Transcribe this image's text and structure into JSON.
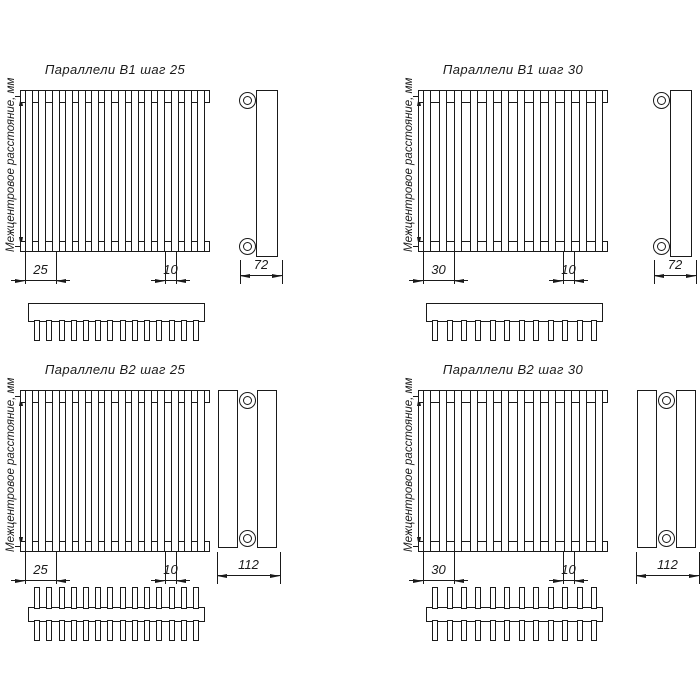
{
  "drawing": {
    "line_color": "#1a1a1a",
    "axis_label": "Межцентровое расстояние, мм",
    "panels": [
      {
        "id": "parallel-b1-step-25",
        "title": "Параллели В1 шаг 25",
        "pitch_dim": "25",
        "end_dim": "10",
        "depth_dim": "72",
        "tubes": 14,
        "rows": 1
      },
      {
        "id": "parallel-b1-step-30",
        "title": "Параллели В1 шаг 30",
        "pitch_dim": "30",
        "end_dim": "10",
        "depth_dim": "72",
        "tubes": 12,
        "rows": 1
      },
      {
        "id": "parallel-b2-step-25",
        "title": "Параллели В2 шаг 25",
        "pitch_dim": "25",
        "end_dim": "10",
        "depth_dim": "112",
        "tubes": 14,
        "rows": 2
      },
      {
        "id": "parallel-b2-step-30",
        "title": "Параллели В2 шаг 30",
        "pitch_dim": "30",
        "end_dim": "10",
        "depth_dim": "112",
        "tubes": 12,
        "rows": 2
      }
    ]
  }
}
